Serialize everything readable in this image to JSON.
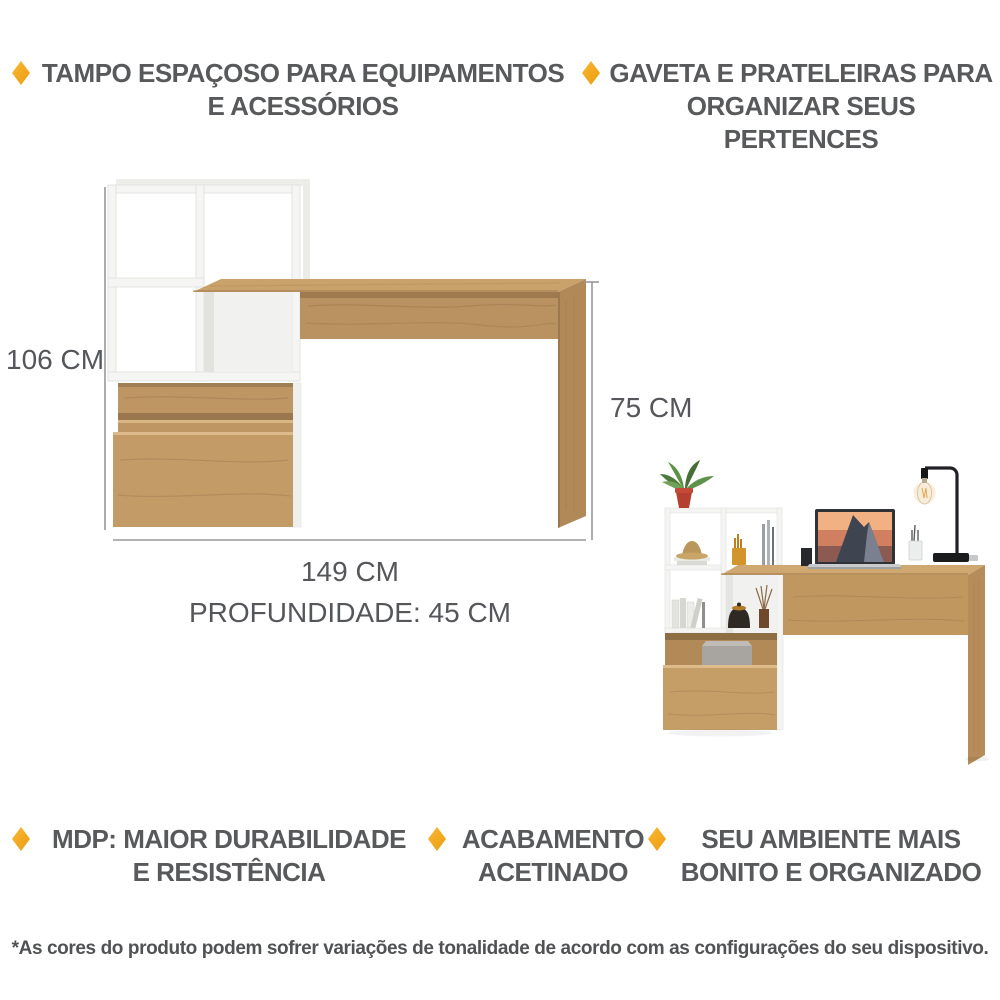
{
  "features_top": [
    {
      "line1": "TAMPO ESPAÇOSO PARA EQUIPAMENTOS",
      "line2": "E ACESSÓRIOS"
    },
    {
      "line1": "GAVETA E PRATELEIRAS PARA",
      "line2": "ORGANIZAR SEUS PERTENCES"
    }
  ],
  "features_bottom": [
    {
      "line1": "MDP: MAIOR DURABILIDADE",
      "line2": "E RESISTÊNCIA"
    },
    {
      "line1": "ACABAMENTO",
      "line2": "ACETINADO"
    },
    {
      "line1": "SEU AMBIENTE MAIS",
      "line2": "BONITO E ORGANIZADO"
    }
  ],
  "diagram": {
    "height_label": "106 CM",
    "desk_height_label": "75 CM",
    "width_label": "149 CM",
    "depth_label": "PROFUNDIDADE: 45 CM",
    "height_cm": 106,
    "desk_height_cm": 75,
    "width_cm": 149,
    "depth_cm": 45
  },
  "footnote": "*As cores do produto podem sofrer variações de tonalidade de acordo com as configurações do seu dispositivo.",
  "colors": {
    "accent_diamond": "#F2A41C",
    "text": "#58595B",
    "wood": "#C49C6A",
    "shelf_white": "#F4F4F2",
    "dimension_line": "#97989B"
  }
}
